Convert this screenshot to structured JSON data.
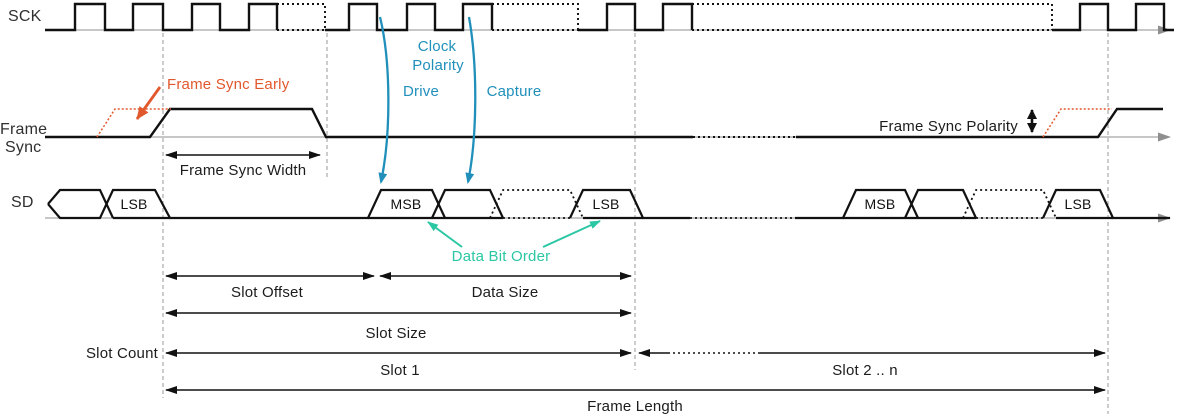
{
  "colors": {
    "orange": "#E2582D",
    "blue": "#2090BB",
    "teal": "#2BC7A4",
    "signal": "#111111",
    "gray": "#8F8F8F",
    "text": "#222222"
  },
  "signals": {
    "sck": {
      "label": "SCK"
    },
    "frame_sync": {
      "label_line1": "Frame",
      "label_line2": "Sync"
    },
    "sd": {
      "label": "SD"
    }
  },
  "sd_cells": {
    "slot0_lsb": "LSB",
    "slot1_msb": "MSB",
    "slot1_lsb": "LSB",
    "slot2_msb": "MSB",
    "slot2_lsb": "LSB"
  },
  "annotations": {
    "frame_sync_early": "Frame Sync Early",
    "clock_polarity_line1": "Clock",
    "clock_polarity_line2": "Polarity",
    "drive": "Drive",
    "capture": "Capture",
    "frame_sync_width": "Frame Sync Width",
    "frame_sync_polarity": "Frame Sync Polarity",
    "data_bit_order": "Data Bit Order"
  },
  "dimensions": {
    "slot_offset": "Slot Offset",
    "data_size": "Data Size",
    "slot_size": "Slot Size",
    "slot_count": "Slot Count",
    "slot_1": "Slot 1",
    "slot_2_n": "Slot 2 .. n",
    "frame_length": "Frame Length"
  }
}
